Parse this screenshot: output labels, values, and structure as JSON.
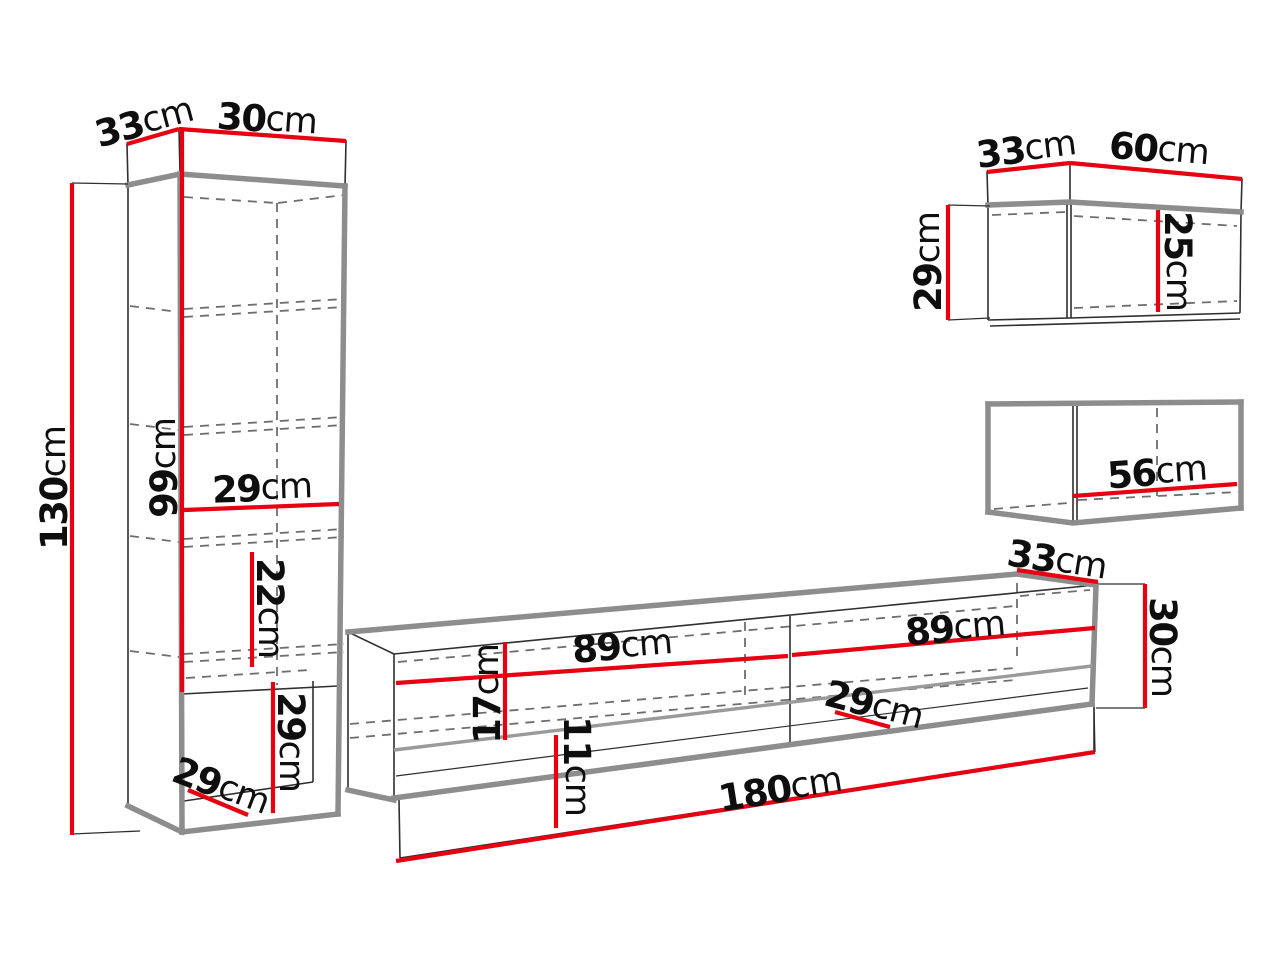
{
  "colors": {
    "red": "#e60012",
    "panel": "#8d8d8d",
    "line": "#2f2f2f",
    "dash": "#6e6e6e",
    "ink": "#0e0e0e",
    "bg": "#ffffff"
  },
  "labels": {
    "tall_cabinet": {
      "depth_top": {
        "value": "33",
        "unit": "cm"
      },
      "width_top": {
        "value": "30",
        "unit": "cm"
      },
      "total_height": {
        "value": "130",
        "unit": "cm"
      },
      "upper_section_height": {
        "value": "99",
        "unit": "cm"
      },
      "inner_width": {
        "value": "29",
        "unit": "cm"
      },
      "shelf_spacing": {
        "value": "22",
        "unit": "cm"
      },
      "niche_height": {
        "value": "29",
        "unit": "cm"
      },
      "niche_depth": {
        "value": "29",
        "unit": "cm"
      }
    },
    "tv_stand": {
      "left_section_width": {
        "value": "89",
        "unit": "cm"
      },
      "right_section_width": {
        "value": "89",
        "unit": "cm"
      },
      "front_height": {
        "value": "17",
        "unit": "cm"
      },
      "niche_height": {
        "value": "11",
        "unit": "cm"
      },
      "niche_depth": {
        "value": "29",
        "unit": "cm"
      },
      "total_width": {
        "value": "180",
        "unit": "cm"
      },
      "depth_top": {
        "value": "33",
        "unit": "cm"
      },
      "side_height": {
        "value": "30",
        "unit": "cm"
      }
    },
    "wall_cabinet_upper": {
      "depth_top": {
        "value": "33",
        "unit": "cm"
      },
      "width_top": {
        "value": "60",
        "unit": "cm"
      },
      "side_height": {
        "value": "29",
        "unit": "cm"
      },
      "inner_height": {
        "value": "25",
        "unit": "cm"
      }
    },
    "wall_cabinet_lower": {
      "inner_width": {
        "value": "56",
        "unit": "cm"
      }
    }
  }
}
